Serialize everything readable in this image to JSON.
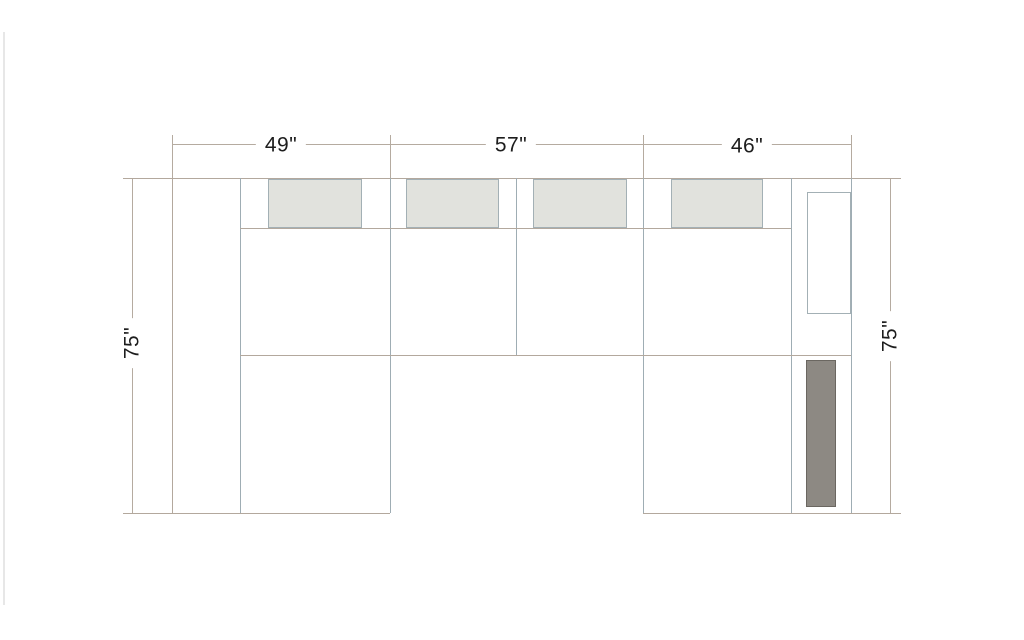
{
  "diagram": {
    "title": "sectional-sofa-top-view-dimension-drawing",
    "labels": {
      "top_left_width": "49\"",
      "top_middle_width": "57\"",
      "top_right_width": "46\"",
      "left_depth": "75\"",
      "right_depth": "75\""
    },
    "colors": {
      "dimension_line": "#b5aba0",
      "outline_warm": "#b3a89d",
      "outline_cool": "#9fadb4",
      "cushion_fill": "#e1e2dd",
      "cushion_border": "#a3b0b5",
      "accent_rect_fill": "#8d8983",
      "accent_rect_border": "#6b6761",
      "label_text": "#1d1d1d",
      "page_edge_line": "#e7e7e7",
      "background": "#ffffff"
    }
  }
}
